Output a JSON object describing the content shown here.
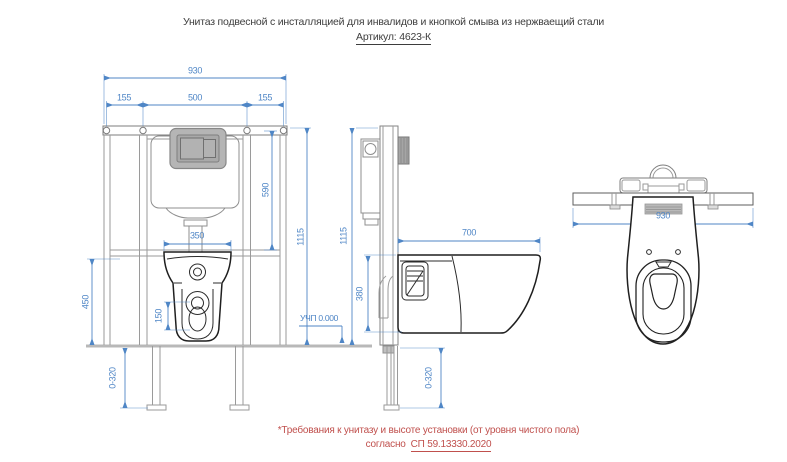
{
  "drawing": {
    "title": "Унитаз подвесной с инсталляцией для инвалидов и кнопкой смыва из нержваещий стали",
    "article": "Артикул: 4623-К"
  },
  "dims": {
    "front": {
      "overall": "930",
      "left": "155",
      "center": "500",
      "right": "155",
      "upper": "590",
      "height": "1115",
      "seat": "450",
      "bowl_width": "350",
      "drain": "150",
      "legs": "0-320"
    },
    "side": {
      "height": "1115",
      "depth": "700",
      "bowl_height": "380",
      "floor_level": "УЧП 0.000",
      "legs": "0-320"
    },
    "top": {
      "overall": "930"
    }
  },
  "footnote": {
    "line1": "*Требования к унитазу и высоте установки (от уровня чистого пола)",
    "prefix": "согласно",
    "reference": "СП 59.13330.2020"
  },
  "colors": {
    "dimension_blue": "#4f86c6",
    "line_dark": "#2e2e2e",
    "accent_red": "#c0504d",
    "fill_gray": "#b5b5b5"
  }
}
